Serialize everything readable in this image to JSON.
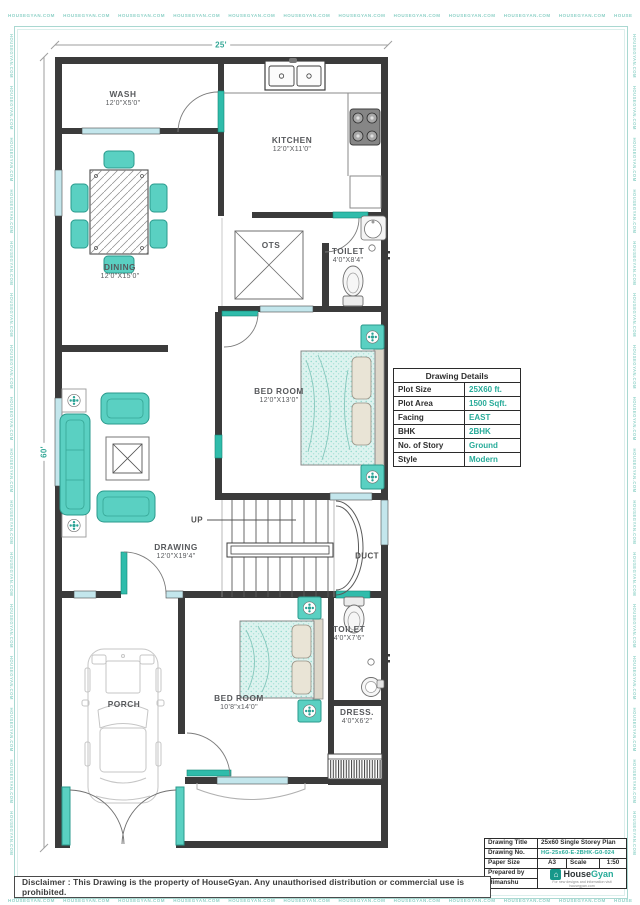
{
  "watermark": {
    "text": "HOUSEGYAN.COM"
  },
  "dimensions": {
    "width_label": "25'",
    "height_label": "60'"
  },
  "rooms": {
    "wash": {
      "name": "WASH",
      "size": "12'0\"X5'0\""
    },
    "kitchen": {
      "name": "KITCHEN",
      "size": "12'0\"X11'0\""
    },
    "dining": {
      "name": "DINING",
      "size": "12'0\"X15'0\""
    },
    "ots": {
      "name": "OTS"
    },
    "toilet1": {
      "name": "TOILET",
      "size": "4'0\"X8'4\""
    },
    "bedroom1": {
      "name": "BED ROOM",
      "size": "12'0\"X13'0\""
    },
    "drawing": {
      "name": "DRAWING",
      "size": "12'0\"X19'4\""
    },
    "toilet2": {
      "name": "TOILET",
      "size": "4'0\"X7'6\""
    },
    "bedroom2": {
      "name": "BED ROOM",
      "size": "10'8\"x14'0\""
    },
    "dress": {
      "name": "DRESS.",
      "size": "4'0\"X6'2\""
    },
    "porch": {
      "name": "PORCH"
    }
  },
  "stairs": {
    "up_label": "UP",
    "duct_label": "DUCT"
  },
  "details_table": {
    "title": "Drawing Details",
    "rows": [
      {
        "label": "Plot Size",
        "value": "25X60 ft."
      },
      {
        "label": "Plot Area",
        "value": "1500 Sqft."
      },
      {
        "label": "Facing",
        "value": "EAST"
      },
      {
        "label": "BHK",
        "value": "2BHK"
      },
      {
        "label": "No. of Story",
        "value": "Ground"
      },
      {
        "label": "Style",
        "value": "Modern"
      }
    ]
  },
  "title_block": {
    "drawing_title_label": "Drawing Title",
    "drawing_title": "25x60 Single Storey Plan",
    "drawing_no_label": "Drawing No.",
    "drawing_no": "HG-25x60-E-2BHK-G0-024",
    "paper_size_label": "Paper Size",
    "paper_size": "A3",
    "scale_label": "Scale",
    "scale": "1:50",
    "prepared_by_label": "Prepared by",
    "prepared_by": "Himanshu",
    "brand": {
      "name_1": "House",
      "name_2": "Gyan",
      "house_glyph": "⌂",
      "tagline": "For new designs and information visit housegyan.com"
    }
  },
  "disclaimer": "Disclaimer : This Drawing is the property of HouseGyan. Any unauthorised distribution or commercial use is prohibited.",
  "colors": {
    "accent": "#27ab99",
    "wall": "#3b3b3b",
    "window": "#c3e6ec",
    "door": "#2fbcab",
    "furniture": "#5ad0c2"
  }
}
